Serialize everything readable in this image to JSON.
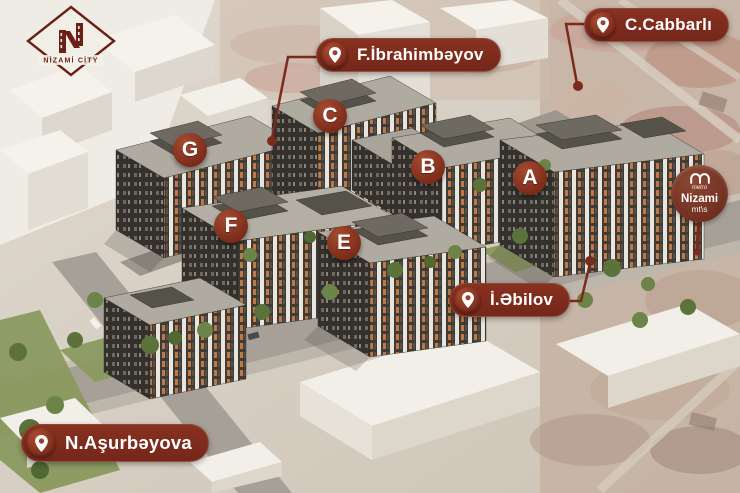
{
  "brand": {
    "name": "NİZAMİ CİTY"
  },
  "street_labels": [
    {
      "id": "f-ibrahimbayov",
      "label": "F.İbrahimbəyov"
    },
    {
      "id": "c-cabbarli",
      "label": "C.Cabbarlı"
    },
    {
      "id": "i-abilov",
      "label": "İ.Əbilov"
    },
    {
      "id": "n-asurbayova",
      "label": "N.Aşurbəyova"
    }
  ],
  "building_markers": [
    {
      "letter": "G"
    },
    {
      "letter": "C"
    },
    {
      "letter": "B"
    },
    {
      "letter": "A"
    },
    {
      "letter": "F"
    },
    {
      "letter": "E"
    }
  ],
  "metro": {
    "brand": "metro",
    "station": "Nizami",
    "line_note": "mt\\s"
  },
  "colors": {
    "accent_maroon": "#7a2b1b",
    "pin_circle": "#a84b31",
    "building_dark": "#3f3b36",
    "building_orange": "#c07944",
    "roof_gray": "#b0aba1",
    "greenery": "#5b733b"
  }
}
